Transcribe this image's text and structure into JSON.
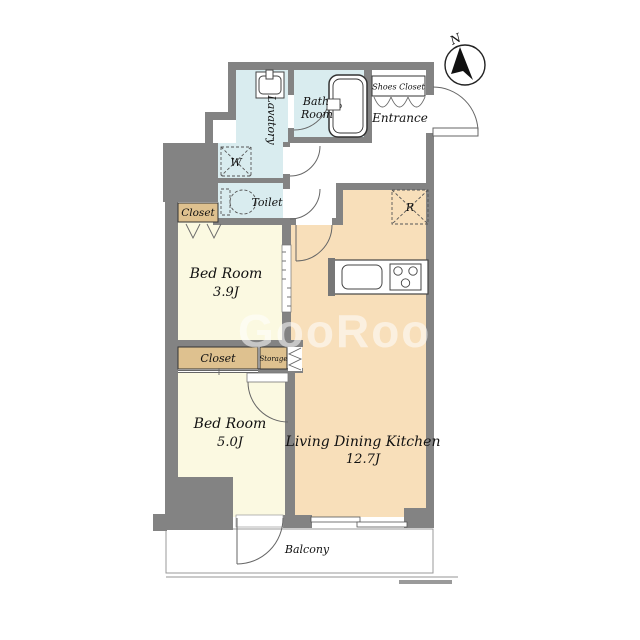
{
  "compass": {
    "north_label": "N"
  },
  "watermark": {
    "text": "GooRooM"
  },
  "rooms": {
    "lavatory": {
      "label": "Lavatory"
    },
    "bath": {
      "label_line1": "Bath",
      "label_line2": "Room"
    },
    "shoes_closet": {
      "label": "Shoes Closet"
    },
    "entrance": {
      "label": "Entrance"
    },
    "toilet": {
      "label": "Toilet"
    },
    "closet_top": {
      "label": "Closet"
    },
    "bedroom1": {
      "name": "Bed Room",
      "size": "3.9J"
    },
    "closet_mid": {
      "label": "Closet"
    },
    "storage": {
      "label": "Storage"
    },
    "bedroom2": {
      "name": "Bed Room",
      "size": "5.0J"
    },
    "ldk": {
      "name": "Living Dining Kitchen",
      "size": "12.7J"
    },
    "balcony": {
      "label": "Balcony"
    }
  },
  "symbols": {
    "washer": "W",
    "refrigerator": "R"
  },
  "colors": {
    "wall": "#838383",
    "bedroom": "#FBF9E1",
    "ldk": "#F8DFBA",
    "water": "#D9ECEF",
    "closet": "#DEC18F",
    "watermark": "#FFFFFF"
  }
}
